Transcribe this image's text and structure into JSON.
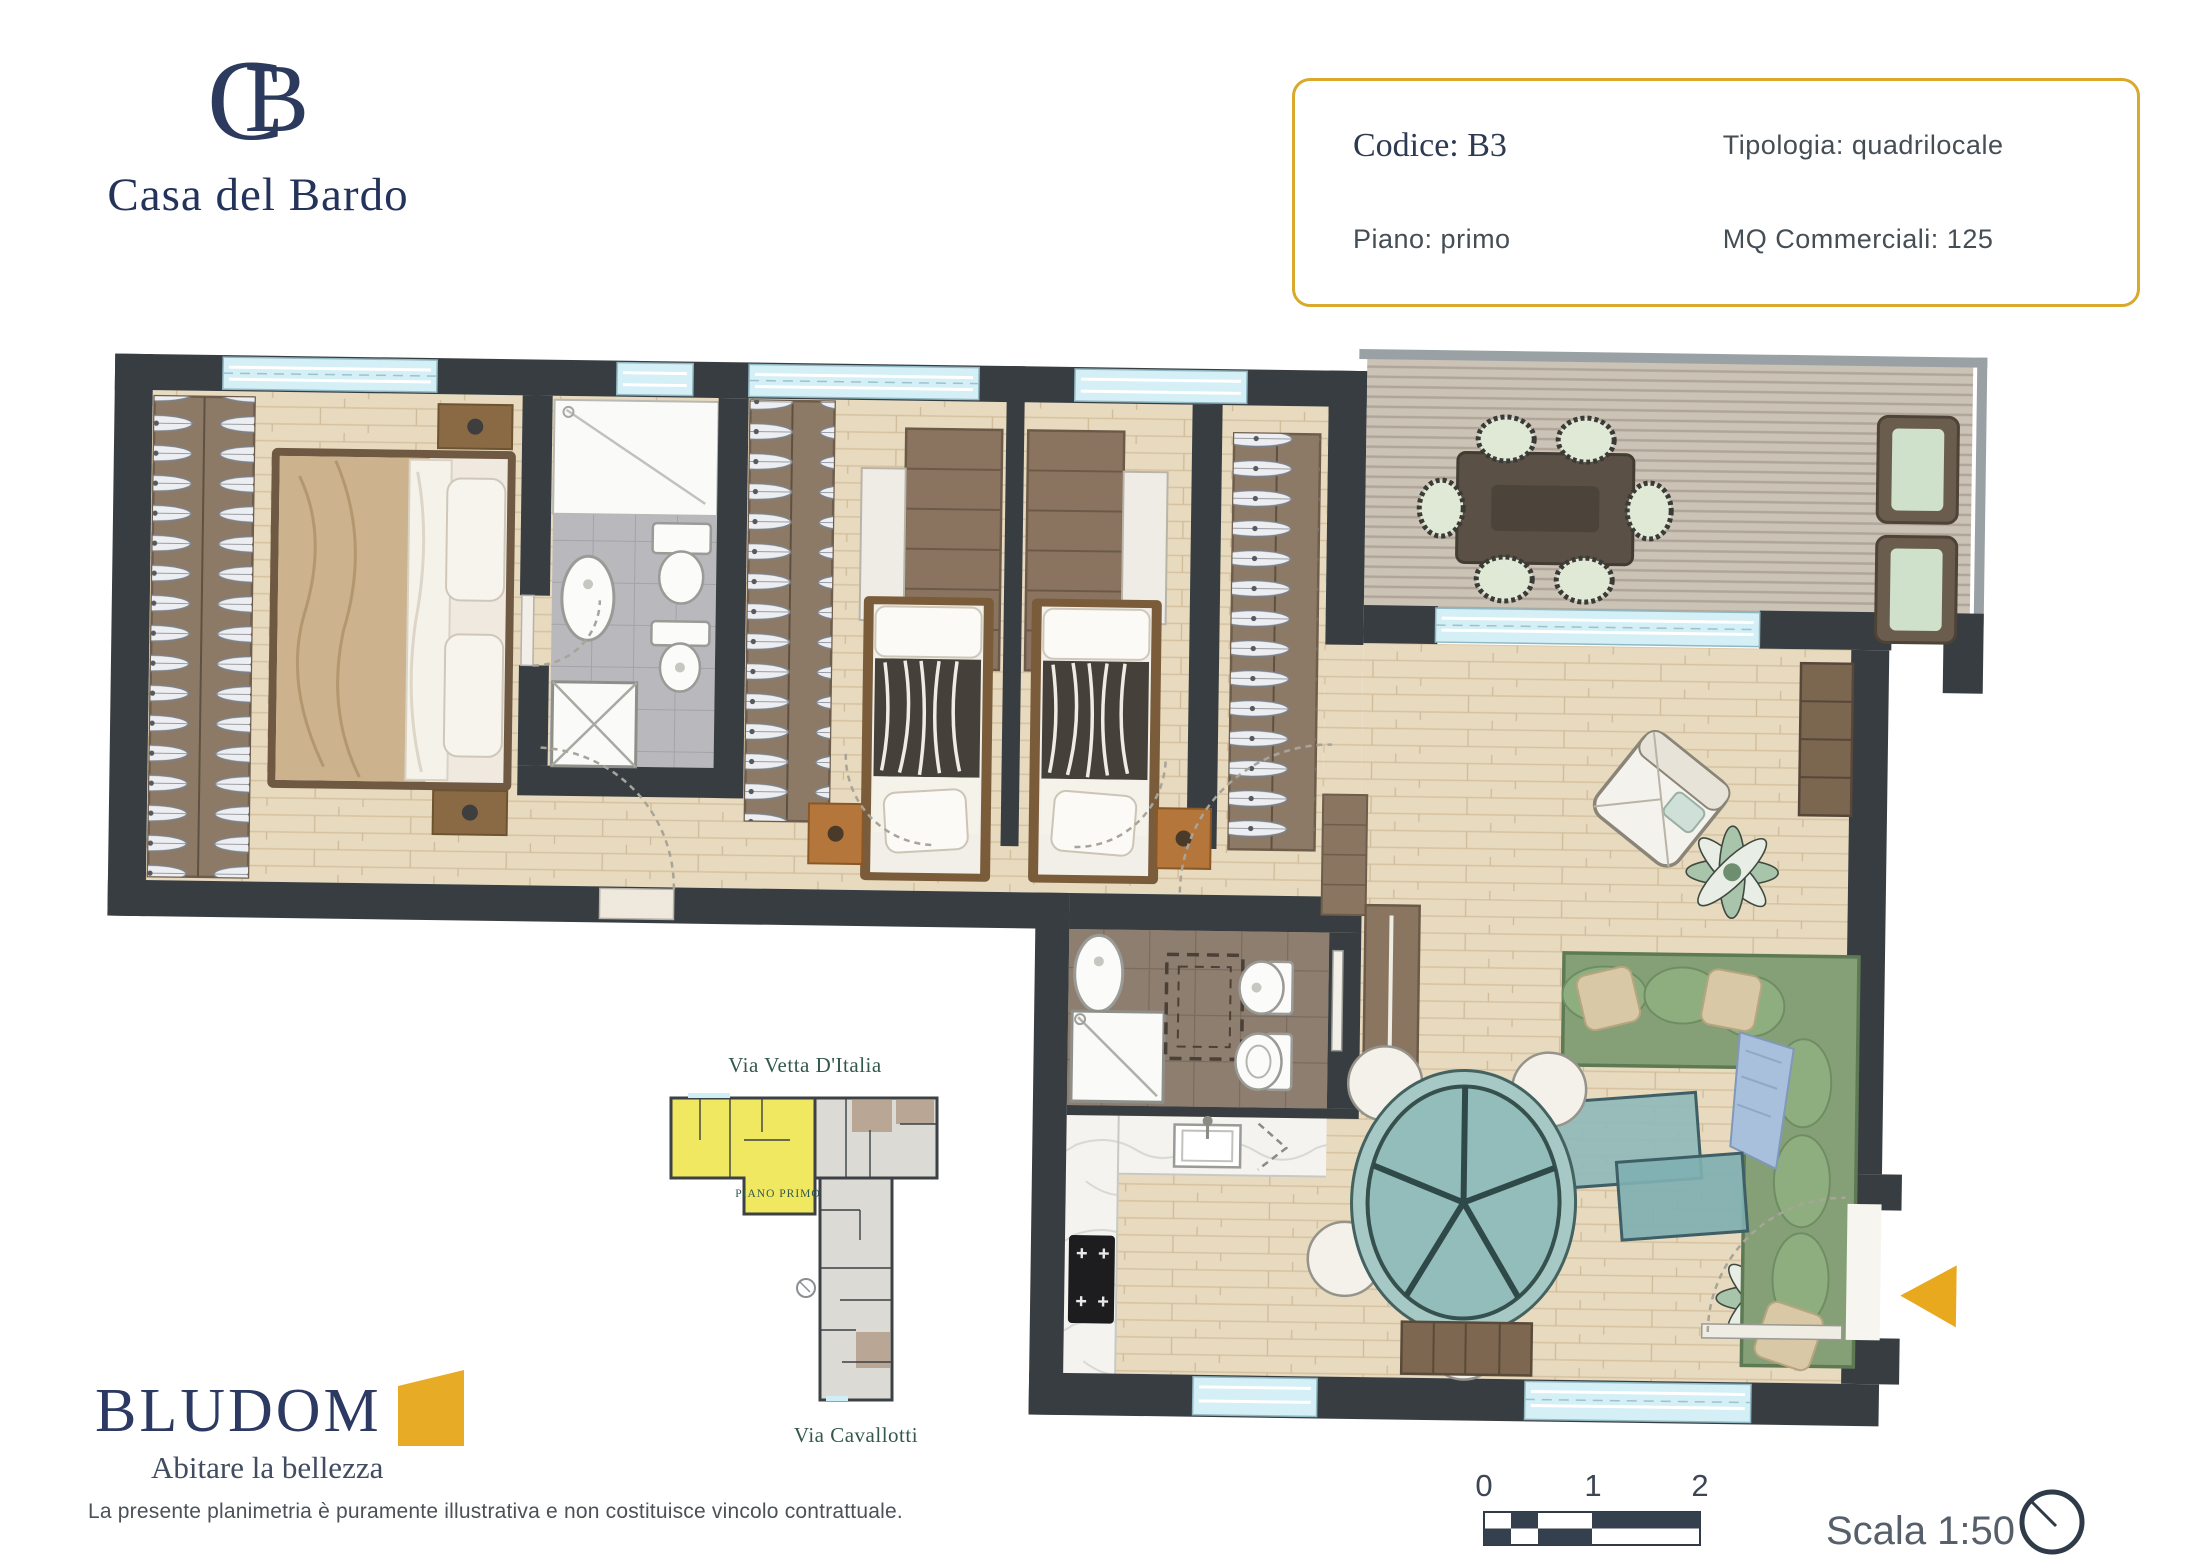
{
  "brand": {
    "monogram": "CB",
    "name": "Casa del Bardo"
  },
  "info_box": {
    "codice": "Codice: B3",
    "tipologia": "Tipologia: quadrilocale",
    "piano": "Piano: primo",
    "mq": "MQ Commerciali: 125"
  },
  "key_plan": {
    "street_top": "Via Vetta D'Italia",
    "floor_label": "PIANO PRIMO",
    "street_bottom": "Via Cavallotti"
  },
  "footer": {
    "developer": "BLUDOM",
    "tagline": "Abitare la bellezza",
    "disclaimer": "La presente planimetria è puramente illustrativa e non costituisce vincolo contrattuale."
  },
  "scale_bar": {
    "ticks": [
      "0",
      "1",
      "2"
    ],
    "label": "Scala 1:50"
  },
  "colors": {
    "accent_gold": "#e2a62c",
    "navy": "#2c3a5e",
    "wall_dark": "#383d41",
    "wood_floor": "#e8dabe",
    "terrace_deck": "#ccc3b7",
    "window_cyan": "#d4eff6",
    "tile_gray": "#b8b8bd",
    "tile_brown": "#8e7e70",
    "sofa_green": "#85a077",
    "glass_teal": "#8fbaba",
    "closet_brown": "#8d7a66",
    "keyplan_yellow": "#f0e860"
  }
}
